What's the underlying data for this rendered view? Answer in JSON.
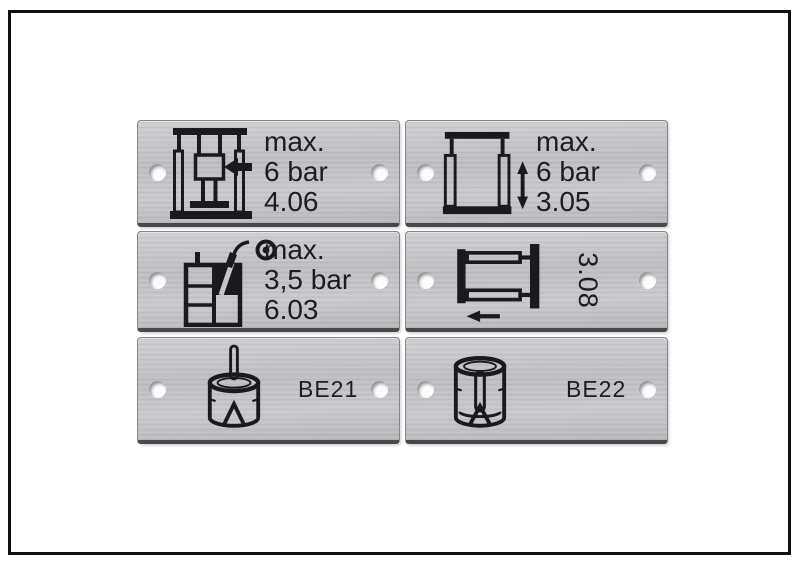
{
  "frame": {
    "border_color": "#111111",
    "background": "#ffffff"
  },
  "colors": {
    "plate_metal": "#c3c3c7",
    "plate_outline": "#84848a",
    "plate_bottom_edge": "#47474c",
    "hole_fill": "#fcfcfd",
    "ink": "#1a1a1c"
  },
  "plates": [
    {
      "icon": "press-ram-left-arrow-icon",
      "lines": [
        "max.",
        "6 bar",
        "4.06"
      ]
    },
    {
      "icon": "press-frame-vertical-arrow-icon",
      "lines": [
        "max.",
        "6 bar",
        "3.05"
      ]
    },
    {
      "icon": "tank-hose-nozzle-icon",
      "lines": [
        "max.",
        "3,5 bar",
        "6.03"
      ]
    },
    {
      "icon": "frame-left-arrow-icon",
      "rotated_label": "3.08"
    },
    {
      "icon": "cylinder-top-pin-icon",
      "label": "BE21"
    },
    {
      "icon": "sleeve-inner-pin-icon",
      "label": "BE22"
    }
  ]
}
